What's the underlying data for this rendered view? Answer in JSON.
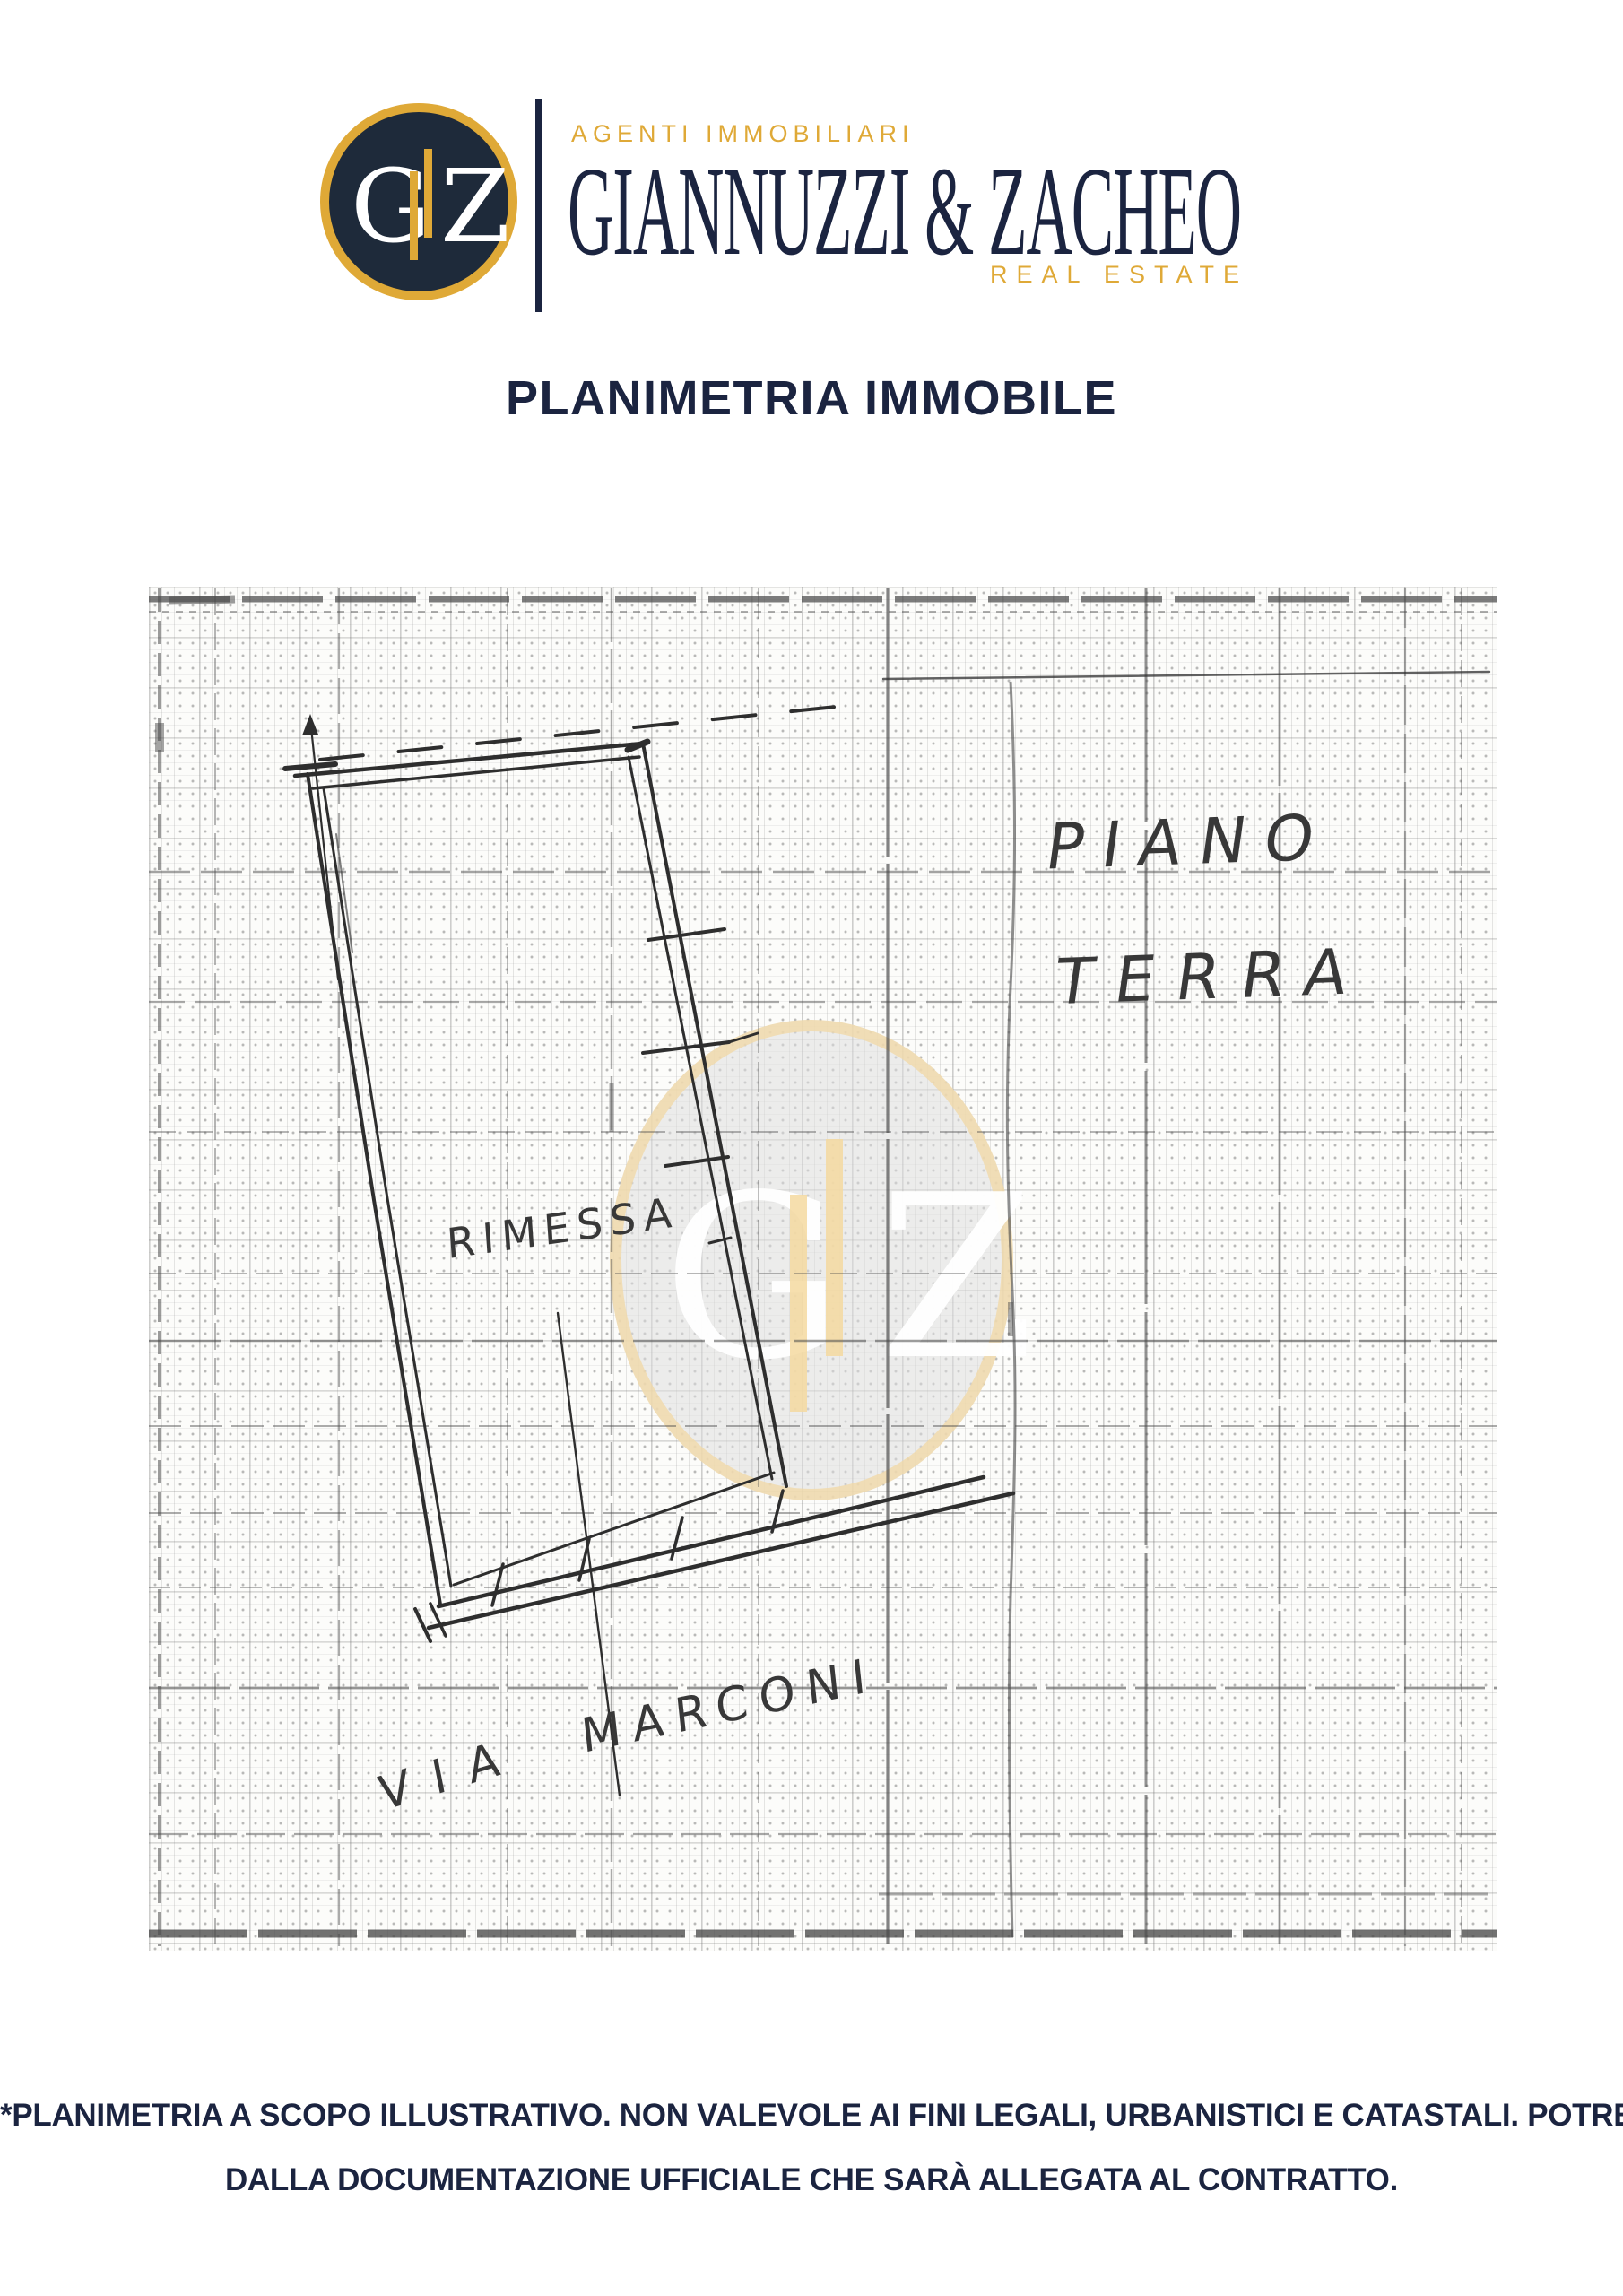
{
  "brand": {
    "monogram": {
      "left": "G",
      "right": "Z"
    },
    "tagline": "AGENTI IMMOBILIARI",
    "name": "GIANNUZZI & ZACHEO",
    "subtitle": "REAL ESTATE"
  },
  "page": {
    "title": "PLANIMETRIA IMMOBILE"
  },
  "plan": {
    "floor_label_line1": "PIANO",
    "floor_label_line2": "TERRA",
    "room_label": "RIMESSA",
    "street_label_word1": "VIA",
    "street_label_word2": "MARCONI",
    "watermark": {
      "left": "G",
      "right": "Z"
    }
  },
  "footer": {
    "line1": "*PLANIMETRIA A SCOPO ILLUSTRATIVO. NON VALEVOLE AI FINI LEGALI, URBANISTICI E CATASTALI. POTREBBE PARZIALMENTE DIFFERIRE",
    "line2": "DALLA DOCUMENTAZIONE UFFICIALE CHE SARÀ ALLEGATA AL CONTRATTO."
  },
  "colors": {
    "navy": "#1B2440",
    "gold": "#DFA937",
    "circle_navy": "#1E2A3A",
    "pencil": "#2E2E2E"
  }
}
